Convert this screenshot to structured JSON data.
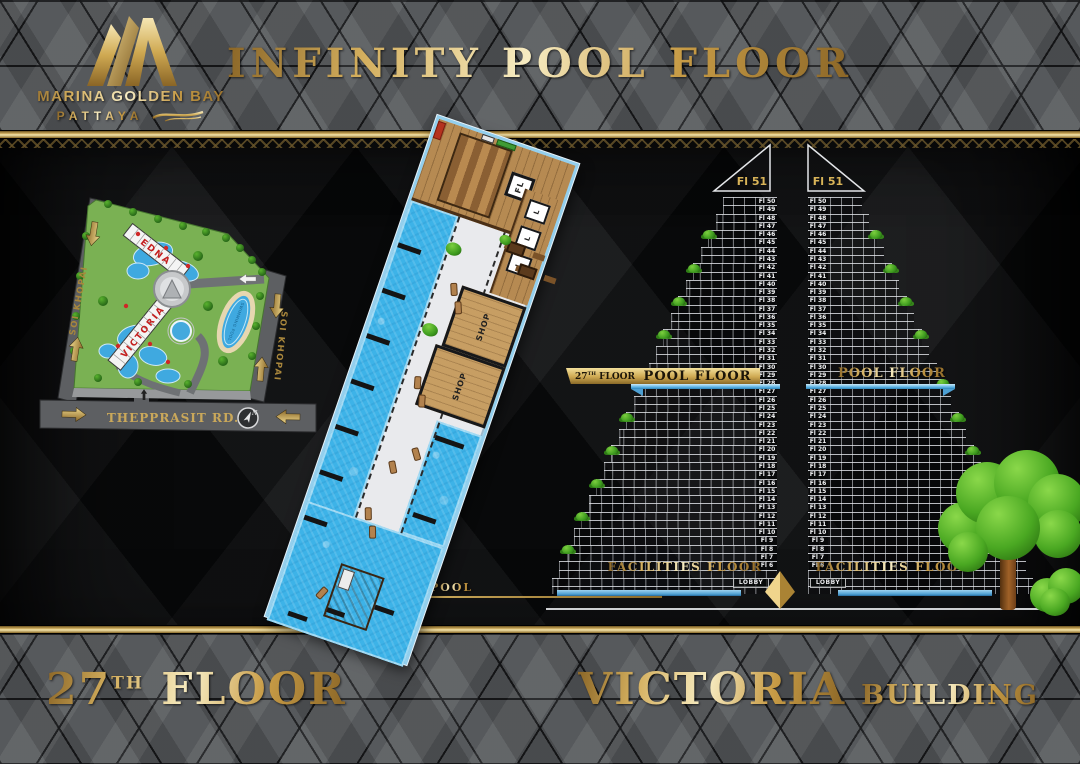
{
  "header": {
    "brand": "MARINA GOLDEN BAY",
    "city": "PATTAYA",
    "title": "INFINITY POOL FLOOR"
  },
  "site_map": {
    "road_left": "SOI KHOPAI",
    "road_right": "SOI KHOPAI",
    "road_bottom": "THEPPRASIT RD.",
    "building_upper": "EDNA",
    "building_lower": "VICTORIA",
    "pool_label": "SWIMMING POOL",
    "compass": "N"
  },
  "floor_plan": {
    "shop": "SHOP",
    "lift": "L",
    "stair_core": "FL",
    "pool_callout": "POOL"
  },
  "towers": {
    "roof_label": "Fl 51",
    "floors": [
      "Fl 50",
      "Fl 49",
      "Fl 48",
      "Fl 47",
      "Fl 46",
      "Fl 45",
      "Fl 44",
      "Fl 43",
      "Fl 42",
      "Fl 41",
      "Fl 40",
      "Fl 39",
      "Fl 38",
      "Fl 37",
      "Fl 36",
      "Fl 35",
      "Fl 34",
      "Fl 33",
      "Fl 32",
      "Fl 31",
      "Fl 30",
      "Fl 29",
      "Fl 28",
      "Fl 27",
      "Fl 26",
      "Fl 25",
      "Fl 24",
      "Fl 23",
      "Fl 22",
      "Fl 21",
      "Fl 20",
      "Fl 19",
      "Fl 18",
      "Fl 17",
      "Fl 16",
      "Fl 15",
      "Fl 14",
      "Fl 13",
      "Fl 12",
      "Fl 11",
      "Fl 10",
      "Fl 9",
      "Fl 8",
      "Fl 7",
      "Fl 6"
    ],
    "pool_banner": "POOL FLOOR",
    "pool_tag": {
      "num": "27",
      "sup": "TH",
      "rest": "FLOOR"
    },
    "facilities": "FACILITIES FLOOR",
    "lobby": "LOBBY"
  },
  "footer": {
    "floor": {
      "num": "27",
      "sup": "TH",
      "rest": "FLOOR"
    },
    "building_name": "VICTORIA",
    "building_word": "BUILDING"
  },
  "colors": {
    "gold": "#c9a24d",
    "gold_light": "#f1dc96",
    "gold_dark": "#8a6a28",
    "pool_blue": "#3db3e8",
    "water_line": "#5fb4e4",
    "site_green": "#7ab153",
    "building_red": "#c41f1f"
  }
}
